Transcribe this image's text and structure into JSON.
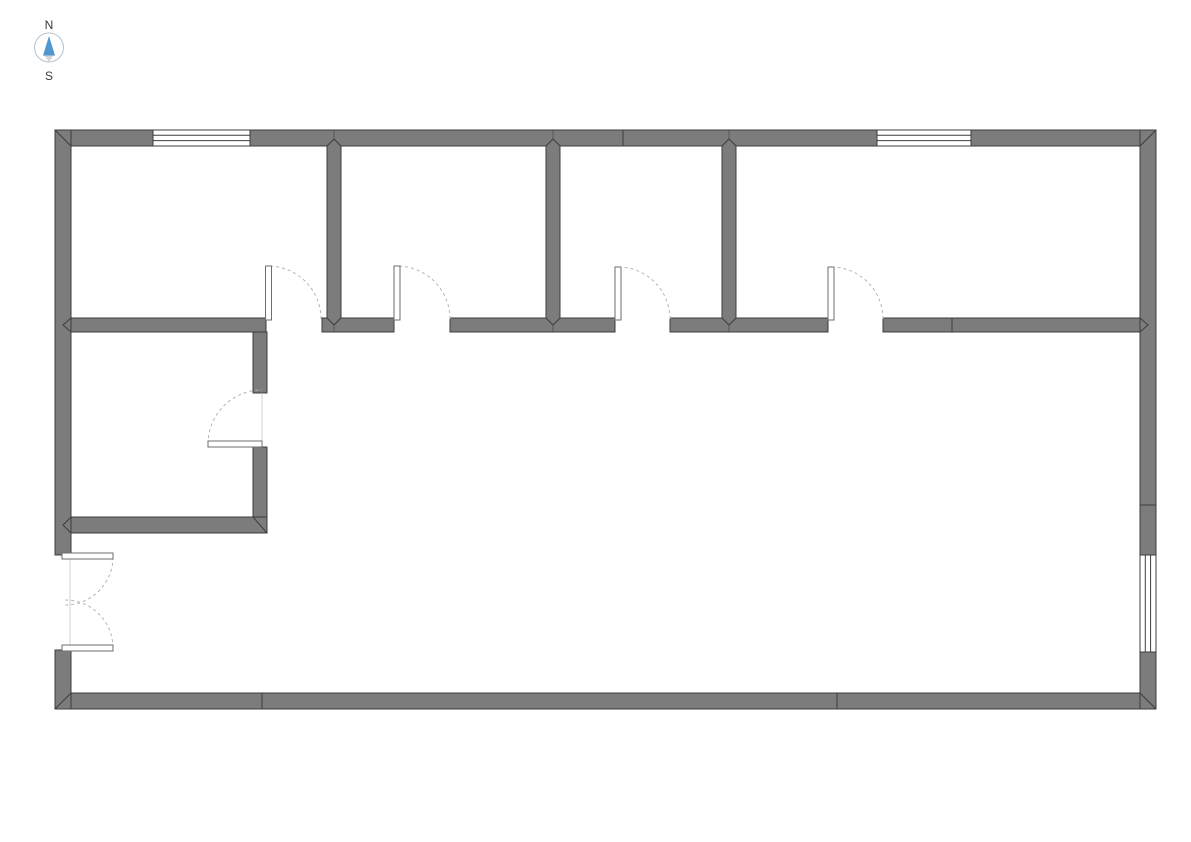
{
  "page": {
    "background": "#ffffff",
    "description": "Floor plan drawing with compass rose, four rooms along the north side, one small room mid-left, and a large open hall"
  },
  "compass": {
    "north_label": "N",
    "south_label": "S"
  },
  "colors": {
    "wall_fill": "#7c7c7c",
    "wall_outline": "#3d3d3d",
    "window_fill": "#ffffff",
    "window_line": "#3d3d3d",
    "door_leaf_outline": "#6e6e6e",
    "door_arc": "#b4b4b4",
    "compass_north_arrow": "#4f97d0",
    "compass_south_arrow": "#d4d4d4",
    "compass_ring": "#b3c3cd",
    "compass_text": "#3a3a3a"
  },
  "floor_plan": {
    "rooms": [
      {
        "id": "room-top-1",
        "position": "top-left",
        "doors": 1,
        "windows": 1
      },
      {
        "id": "room-top-2",
        "position": "top-center-left",
        "doors": 1,
        "windows": 0
      },
      {
        "id": "room-top-3",
        "position": "top-center-right",
        "doors": 1,
        "windows": 0
      },
      {
        "id": "room-top-4",
        "position": "top-right",
        "doors": 1,
        "windows": 1
      },
      {
        "id": "room-side",
        "position": "mid-left",
        "doors": 1,
        "windows": 0
      },
      {
        "id": "hall",
        "position": "main-open-area",
        "doors": 1,
        "windows": 1
      }
    ],
    "doors": [
      {
        "id": "door-1",
        "room": "room-top-1",
        "wall": "south",
        "type": "single-swing",
        "swing": "into-room"
      },
      {
        "id": "door-2",
        "room": "room-top-2",
        "wall": "south",
        "type": "single-swing",
        "swing": "into-room"
      },
      {
        "id": "door-3",
        "room": "room-top-3",
        "wall": "south",
        "type": "single-swing",
        "swing": "into-room"
      },
      {
        "id": "door-4",
        "room": "room-top-4",
        "wall": "south",
        "type": "single-swing",
        "swing": "into-room"
      },
      {
        "id": "door-5",
        "room": "room-side",
        "wall": "east",
        "type": "single-swing",
        "swing": "into-room"
      },
      {
        "id": "door-6",
        "room": "hall",
        "wall": "west-exterior",
        "type": "double-swing",
        "swing": "inward"
      }
    ],
    "windows": [
      {
        "id": "window-1",
        "wall": "north-exterior",
        "near": "room-top-1"
      },
      {
        "id": "window-2",
        "wall": "north-exterior",
        "near": "room-top-4"
      },
      {
        "id": "window-3",
        "wall": "east-exterior",
        "near": "hall"
      }
    ]
  }
}
